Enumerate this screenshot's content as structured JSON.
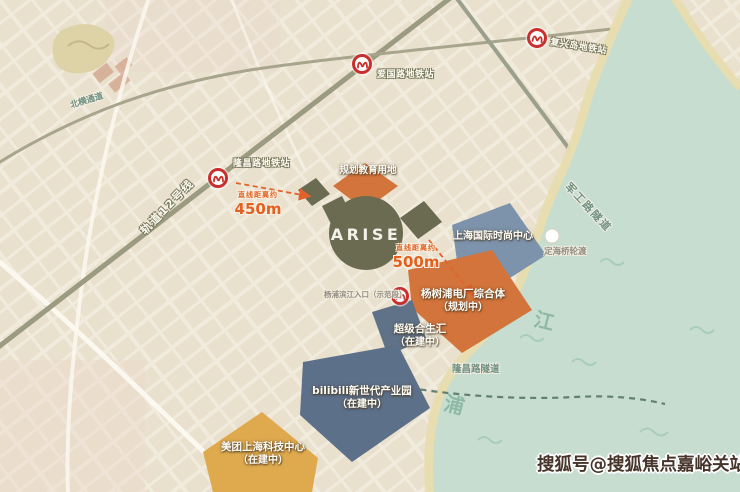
{
  "map": {
    "site": {
      "name": "ARISE"
    },
    "metro": {
      "line_label": "轨道12号线",
      "stations": [
        {
          "label": "隆昌路地铁站"
        },
        {
          "label": "爱国路地铁站"
        },
        {
          "label": "复兴岛地铁站"
        }
      ]
    },
    "roads": {
      "north_tunnel": "北横通道",
      "jungong_tunnel": "军工路隧道",
      "longchang_tunnel": "隆昌路隧道"
    },
    "pois": {
      "education": "规划教育用地",
      "fashion_center": "上海国际时尚中心",
      "power_plant": "杨树浦电厂综合体",
      "power_plant_status": "（规划中）",
      "hopson": "超级合生汇",
      "hopson_status": "（在建中）",
      "bilibili": "bilibili新世代产业园",
      "bilibili_status": "（在建中）",
      "meituan": "美团上海科技中心",
      "meituan_status": "（在建中）",
      "ferry": "定海桥轮渡",
      "riverside_entry": "杨浦滨江入口（示范段）"
    },
    "distances": [
      {
        "prefix": "直线距离约",
        "value": "450m"
      },
      {
        "prefix": "直线距离约",
        "value": "500m"
      }
    ],
    "river": {
      "char_jiang": "江",
      "char_pu": "浦"
    },
    "watermark": "搜狐号@搜狐焦点嘉峪关站",
    "colors": {
      "land": "#ece4d3",
      "river": "#c6ddd0",
      "sand": "#e8dcae",
      "site_olive": "#6a6b51",
      "plot_orange": "#d2743c",
      "plot_blue": "#7d93ab",
      "plot_slate": "#5c7089",
      "plot_amber": "#dfa94e",
      "accent_orange": "#e2622b",
      "metro_red": "#c8302e"
    }
  }
}
